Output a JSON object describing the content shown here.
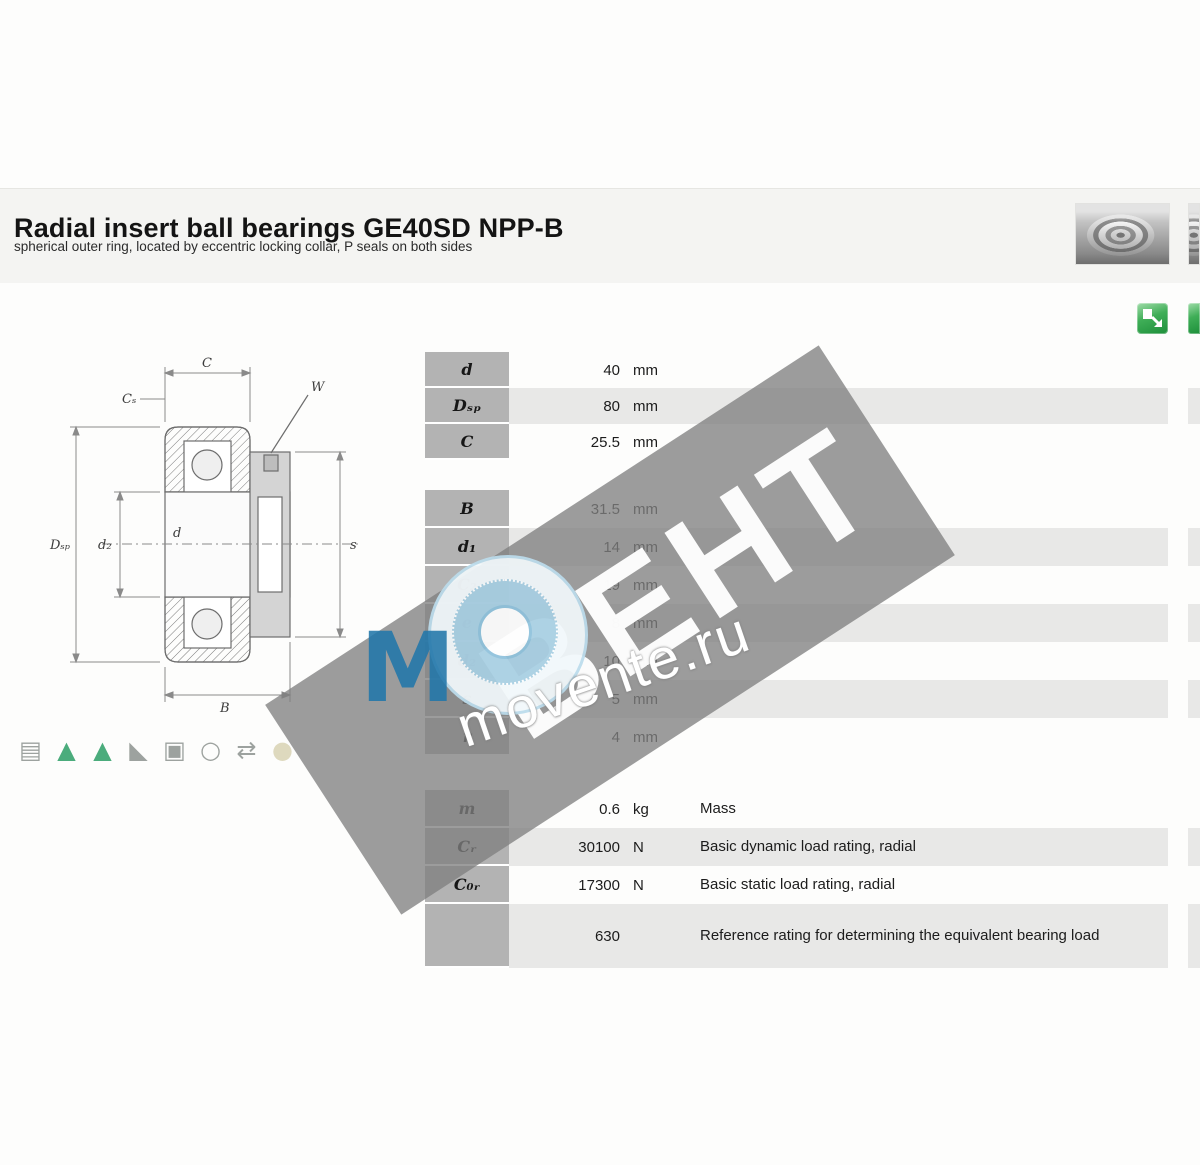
{
  "header": {
    "title": "Radial insert ball bearings GE40SD NPP-B",
    "subtitle": "spherical outer ring, located by eccentric locking collar, P seals on both sides"
  },
  "watermark": {
    "brand": "ВЕНТ",
    "site": "movente.ru"
  },
  "drawing": {
    "labels": {
      "c": "C",
      "cs": "Cₛ",
      "w": "W",
      "dsp": "Dₛₚ",
      "d2": "d₂",
      "d": "d",
      "b": "B",
      "s": "s"
    }
  },
  "feature_icons": [
    {
      "name": "datasheet-icon",
      "glyph": "▤",
      "color": "#8d938f"
    },
    {
      "name": "suitability-static-icon",
      "glyph": "▲",
      "color": "#2d9e66"
    },
    {
      "name": "suitability-dynamic-icon",
      "glyph": "▲",
      "color": "#2d9e66"
    },
    {
      "name": "misalignment-icon",
      "glyph": "◣",
      "color": "#8d938f"
    },
    {
      "name": "seal-icon",
      "glyph": "▣",
      "color": "#8d938f"
    },
    {
      "name": "temperature-icon",
      "glyph": "○",
      "color": "#8d938f"
    },
    {
      "name": "relubrication-icon",
      "glyph": "⇄",
      "color": "#8d938f"
    },
    {
      "name": "grease-icon",
      "glyph": "●",
      "color": "#d9d3b4"
    }
  ],
  "table": {
    "blocks": [
      {
        "rows": [
          {
            "symbol": "d",
            "value": "40",
            "unit": "mm",
            "desc": ""
          },
          {
            "symbol": "Dₛₚ",
            "value": "80",
            "unit": "mm",
            "desc": ""
          },
          {
            "symbol": "C",
            "value": "25.5",
            "unit": "mm",
            "desc": ""
          }
        ]
      },
      {
        "rows": [
          {
            "symbol": "B",
            "value": "31.5",
            "unit": "mm",
            "desc": ""
          },
          {
            "symbol": "d₁",
            "value": "14",
            "unit": "mm",
            "desc": ""
          },
          {
            "symbol": "C₂",
            "value": "19",
            "unit": "mm",
            "desc": ""
          },
          {
            "symbol": "e",
            "value": "8",
            "unit": "mm",
            "desc": ""
          },
          {
            "symbol": "d₂",
            "value": "10",
            "unit": "mm",
            "desc": ""
          },
          {
            "symbol": "s",
            "value": "5",
            "unit": "mm",
            "desc": ""
          },
          {
            "symbol": "r",
            "value": "4",
            "unit": "mm",
            "desc": ""
          }
        ]
      },
      {
        "rows": [
          {
            "symbol": "m",
            "value": "0.6",
            "unit": "kg",
            "desc": "Mass"
          },
          {
            "symbol": "Cᵣ",
            "value": "30100",
            "unit": "N",
            "desc": "Basic dynamic load rating, radial"
          },
          {
            "symbol": "C₀ᵣ",
            "value": "17300",
            "unit": "N",
            "desc": "Basic static load rating, radial"
          },
          {
            "symbol": "",
            "value": "630",
            "unit": "",
            "desc": "Reference rating for determining the equivalent bearing load"
          }
        ]
      }
    ]
  }
}
